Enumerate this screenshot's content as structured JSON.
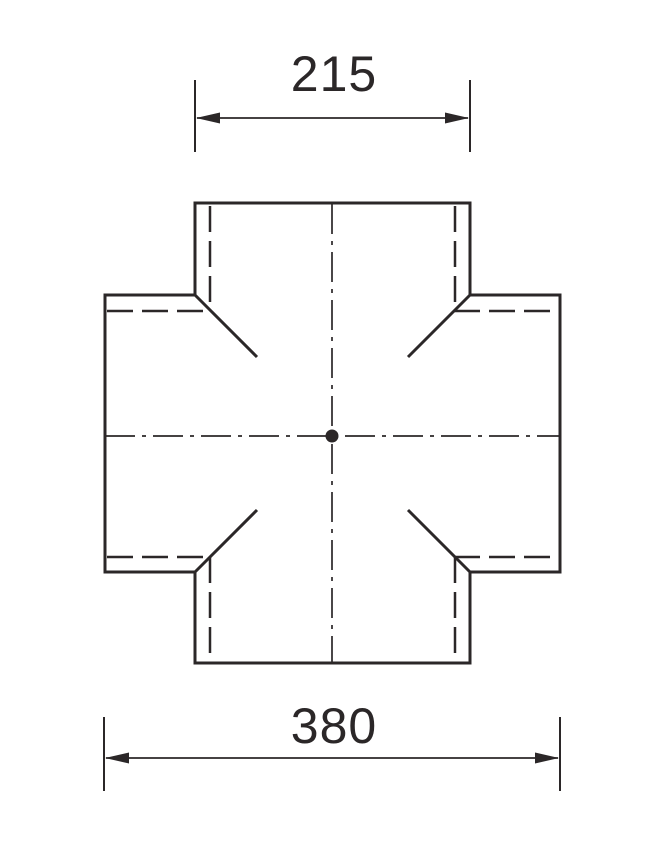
{
  "drawing": {
    "type": "technical-drawing",
    "subject": "four-way cross fitting, plan view",
    "dimensions": {
      "top": {
        "value": "215"
      },
      "bottom": {
        "value": "380"
      }
    },
    "colors": {
      "line": "#2b2728",
      "background": "#ffffff"
    }
  }
}
